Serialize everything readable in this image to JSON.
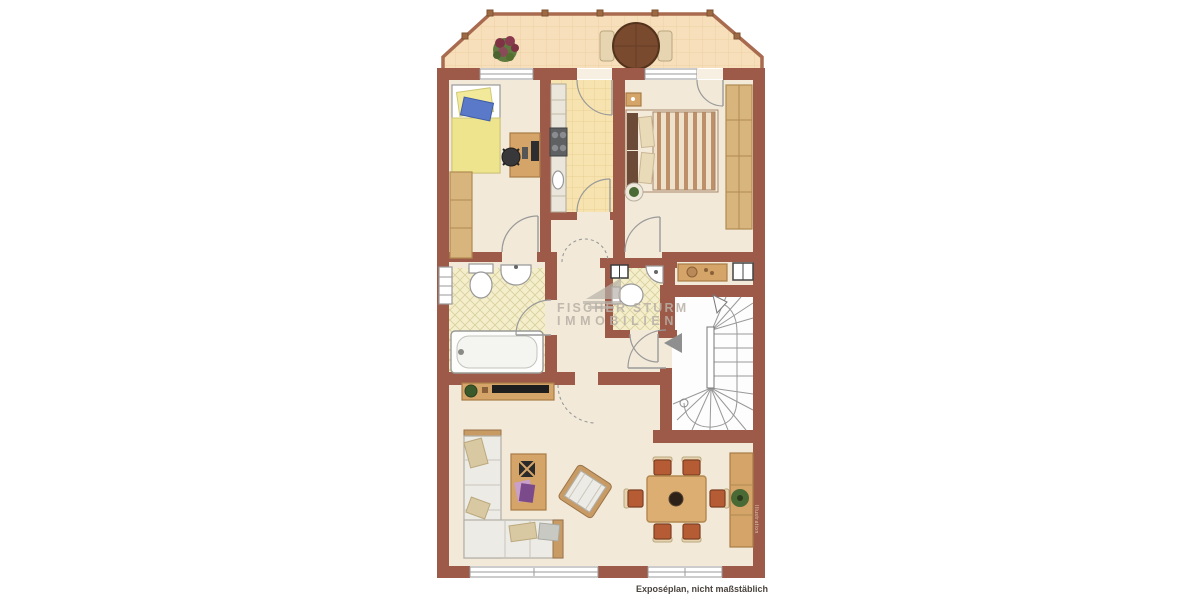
{
  "watermark": {
    "line1": "FISCHER STURM",
    "line2": "IMMOBILIEN",
    "logo": "sail-roof-logo"
  },
  "notes": {
    "disclaimer": "Exposéplan, nicht maßstäblich",
    "side_vertical": "Illustration"
  },
  "colors": {
    "page_bg": "#ffffff",
    "wall": "#9e5a49",
    "floor_cream": "#f2e9d8",
    "balcony_tile": "#f8dfbc",
    "balcony_tile_line": "#ecd0a2",
    "kitchen_tile": "#f7e3b0",
    "kitchen_tile_line": "#e9d092",
    "bath_tile": "#f4eecb",
    "bath_tile_line": "#d9d09e",
    "stair_floor": "#fdfdfd",
    "stair_line": "#999999",
    "wood": "#d5a468",
    "wood_dark": "#a87c48",
    "wood_light": "#d9b57e",
    "sofa": "#edebe5",
    "sofa_edge": "#b2afa6",
    "cushion": "#d9c9a2",
    "terracotta": "#b55c35",
    "terracotta_dark": "#7e3f22",
    "white_fixture": "#ffffff",
    "fixture_line": "#999999",
    "watermark": "#b9b0a6",
    "disclaimer_text": "#4a443e",
    "arrow_gray": "#8f8f8f",
    "plant_green": "#4a6a35",
    "bed_yellow": "#efe48e",
    "bed_blue": "#5b79c9"
  },
  "plan": {
    "type": "apartment-floor-plan",
    "rooms": [
      "balcony",
      "bedroom-left",
      "kitchen",
      "bedroom-right",
      "hallway",
      "bathroom",
      "wc",
      "stairwell",
      "living-dining-room"
    ],
    "furniture": [
      "balcony-table-with-chairs",
      "balcony-plant",
      "single-bed",
      "desk-with-chair",
      "wardrobe",
      "kitchen-counter",
      "stove",
      "kitchen-sink",
      "double-bed",
      "bedside-table",
      "built-in-wardrobe",
      "console-table",
      "bathtub",
      "toilet",
      "washbasin",
      "radiator",
      "corner-sink",
      "winder-staircase",
      "entrance-arrow",
      "tv-lowboard",
      "corner-sofa",
      "coffee-table",
      "armchair",
      "dining-table-six-chairs",
      "sideboard-with-plant"
    ]
  }
}
